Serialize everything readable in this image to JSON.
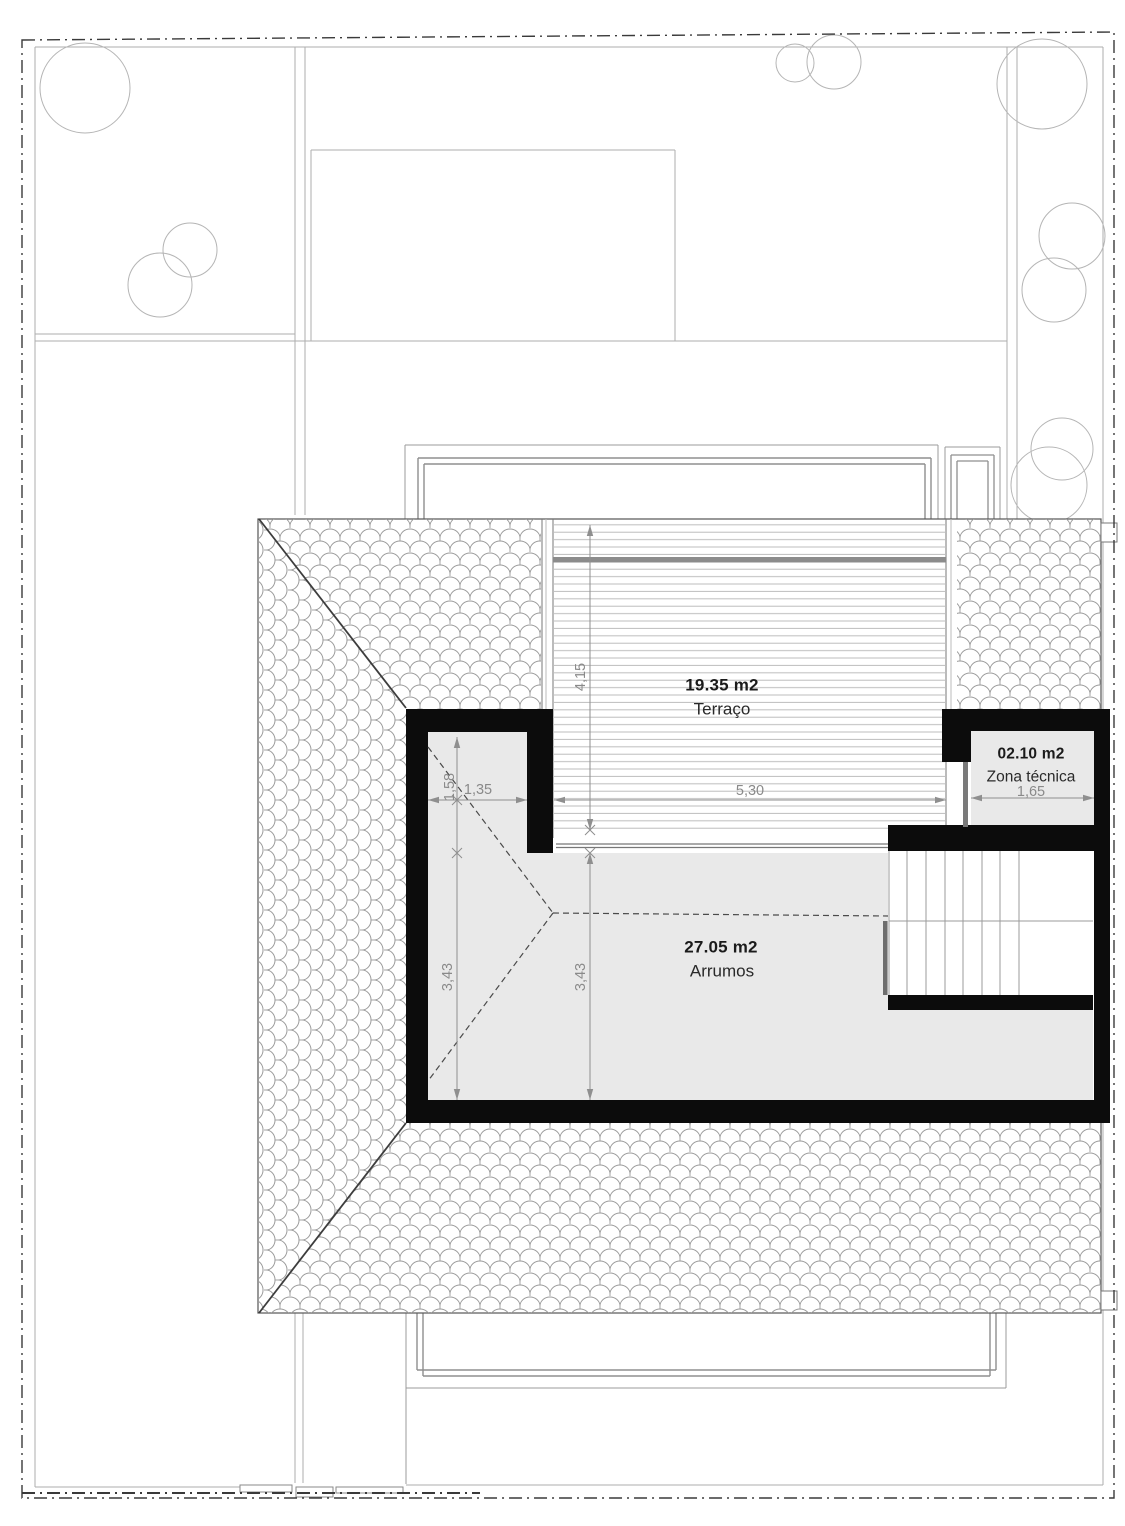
{
  "plan": {
    "rooms": [
      {
        "area": "19.35 m2",
        "name": "Terraço"
      },
      {
        "area": "27.05 m2",
        "name": "Arrumos"
      },
      {
        "area": "02.10 m2",
        "name": "Zona técnica"
      }
    ],
    "dimensions": {
      "terrace_depth": "4,15",
      "terrace_width": "5,30",
      "nook_width": "1,35",
      "nook_depth": "1,58",
      "storage_depth_left": "3,43",
      "storage_depth_right": "3,43",
      "technical_zone_width": "1,65"
    },
    "colors": {
      "wall": "#0c0c0c",
      "room_fill": "#e9e9e9",
      "line_gray": "#a9a9a9",
      "dim_gray": "#8f8f8f"
    }
  }
}
